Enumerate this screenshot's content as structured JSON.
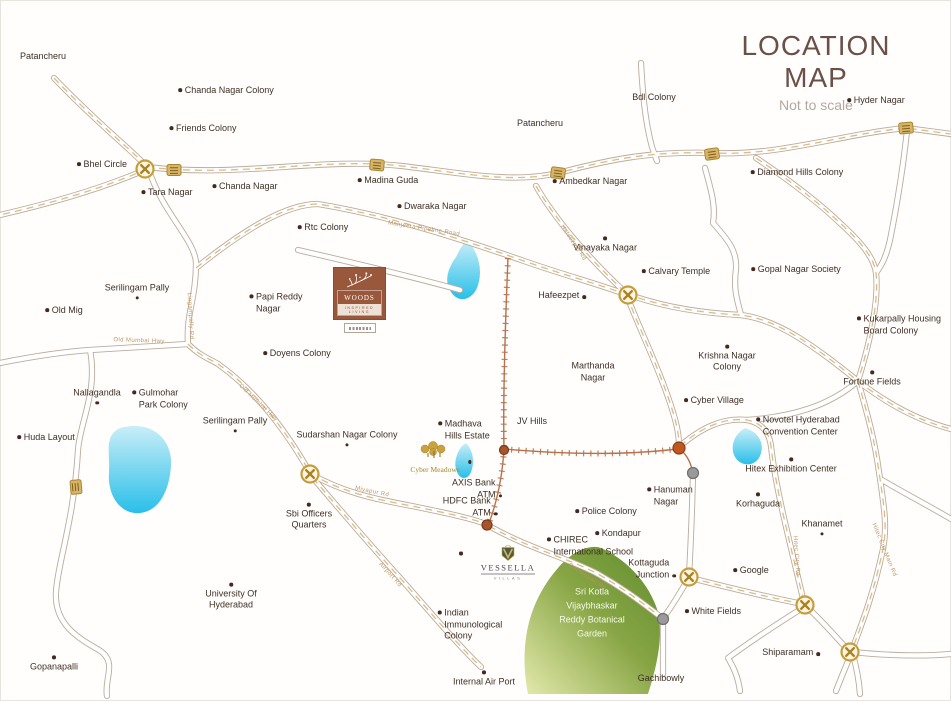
{
  "title": "LOCATION MAP",
  "subtitle": "Not to scale",
  "colors": {
    "title": "#6b5048",
    "accent_gold": "#c69d3c",
    "road_outline": "#bcab9c",
    "highway_dash": "#d9bd85",
    "water": "#29bfe9",
    "garden_green": "#5f8d2f",
    "logo_brown": "#99573b",
    "railway": "#b5724d",
    "label_text": "#3f2f26"
  },
  "logos": {
    "woods": {
      "name": "WOODS",
      "tagline": "INSPIRED LIVING"
    },
    "vessella": {
      "name": "VESSELLA",
      "tagline": "VILLAS"
    },
    "cyber_meadows": {
      "label": "Cyber Meadows"
    }
  },
  "garden": {
    "lines": [
      "Sri Kotla",
      "Vijaybhaskar",
      "Reddy Botanical",
      "Garden"
    ]
  },
  "places": [
    {
      "t": [
        "Patancheru"
      ],
      "x": 43,
      "y": 57,
      "d": "n"
    },
    {
      "t": [
        "Chanda Nagar Colony"
      ],
      "x": 226,
      "y": 91,
      "d": "l"
    },
    {
      "t": [
        "Friends Colony"
      ],
      "x": 203,
      "y": 129,
      "d": "l"
    },
    {
      "t": [
        "Bhel Circle"
      ],
      "x": 102,
      "y": 165,
      "d": "l"
    },
    {
      "t": [
        "Tara Nagar"
      ],
      "x": 167,
      "y": 193,
      "d": "l"
    },
    {
      "t": [
        "Chanda Nagar"
      ],
      "x": 245,
      "y": 187,
      "d": "l"
    },
    {
      "t": [
        "Patancheru"
      ],
      "x": 540,
      "y": 124,
      "d": "n"
    },
    {
      "t": [
        "Madina Guda"
      ],
      "x": 388,
      "y": 181,
      "d": "l"
    },
    {
      "t": [
        "Ambedkar Nagar"
      ],
      "x": 590,
      "y": 182,
      "d": "l"
    },
    {
      "t": [
        "Dwaraka Nagar"
      ],
      "x": 432,
      "y": 207,
      "d": "l"
    },
    {
      "t": [
        "Rtc Colony"
      ],
      "x": 323,
      "y": 228,
      "d": "l"
    },
    {
      "t": [
        "Bdl Colony"
      ],
      "x": 654,
      "y": 98,
      "d": "n"
    },
    {
      "t": [
        "Hyder Nagar"
      ],
      "x": 876,
      "y": 101,
      "d": "l"
    },
    {
      "t": [
        "Diamond Hills Colony"
      ],
      "x": 797,
      "y": 173,
      "d": "l"
    },
    {
      "t": [
        "Vinayaka Nagar"
      ],
      "x": 605,
      "y": 245,
      "d": "a"
    },
    {
      "t": [
        "Calvary Temple"
      ],
      "x": 676,
      "y": 272,
      "d": "l"
    },
    {
      "t": [
        "Gopal Nagar Society"
      ],
      "x": 796,
      "y": 270,
      "d": "l"
    },
    {
      "t": [
        "Kukarpally Housing",
        "Board Colony"
      ],
      "x": 899,
      "y": 325,
      "d": "l"
    },
    {
      "t": [
        "Serilingam Pally"
      ],
      "x": 137,
      "y": 291,
      "d": "b"
    },
    {
      "t": [
        "Old Mig"
      ],
      "x": 64,
      "y": 311,
      "d": "l"
    },
    {
      "t": [
        "Papi Reddy",
        "Nagar"
      ],
      "x": 276,
      "y": 303,
      "d": "l"
    },
    {
      "t": [
        "Doyens Colony"
      ],
      "x": 297,
      "y": 354,
      "d": "l"
    },
    {
      "t": [
        "Krishna Nagar",
        "Colony"
      ],
      "x": 727,
      "y": 359,
      "d": "a"
    },
    {
      "t": [
        "Fortune Fields"
      ],
      "x": 872,
      "y": 379,
      "d": "a"
    },
    {
      "t": [
        "Marthanda",
        "Nagar"
      ],
      "x": 593,
      "y": 372,
      "d": "n"
    },
    {
      "t": [
        "Hafeezpet"
      ],
      "x": 562,
      "y": 296,
      "d": "r"
    },
    {
      "t": [
        "JV Hills"
      ],
      "x": 532,
      "y": 422,
      "d": "n"
    },
    {
      "t": [
        "Madhava",
        "Hills Estate"
      ],
      "x": 464,
      "y": 430,
      "d": "l"
    },
    {
      "t": [
        "Nallagandla"
      ],
      "x": 97,
      "y": 396,
      "d": "b"
    },
    {
      "t": [
        "Gulmohar",
        "Park Colony"
      ],
      "x": 160,
      "y": 399,
      "d": "l"
    },
    {
      "t": [
        "Serilingam Pally"
      ],
      "x": 235,
      "y": 424,
      "d": "b"
    },
    {
      "t": [
        "Huda Layout"
      ],
      "x": 46,
      "y": 438,
      "d": "l"
    },
    {
      "t": [
        "Sudarshan Nagar Colony"
      ],
      "x": 347,
      "y": 438,
      "d": "b"
    },
    {
      "t": [
        "Cyber Village"
      ],
      "x": 714,
      "y": 401,
      "d": "l"
    },
    {
      "t": [
        "Novotel Hyderabad",
        "Convention Center"
      ],
      "x": 798,
      "y": 426,
      "d": "l"
    },
    {
      "t": [
        "Hitex Exhibition Center"
      ],
      "x": 791,
      "y": 466,
      "d": "a"
    },
    {
      "t": [
        "Korhaguda"
      ],
      "x": 758,
      "y": 501,
      "d": "a"
    },
    {
      "t": [
        "Khanamet"
      ],
      "x": 822,
      "y": 527,
      "d": "b"
    },
    {
      "t": [
        "Hanuman",
        "Nagar"
      ],
      "x": 670,
      "y": 496,
      "d": "l"
    },
    {
      "t": [
        "Sbi Officers",
        "Quarters"
      ],
      "x": 309,
      "y": 517,
      "d": "a"
    },
    {
      "t": [
        "AXIS Bank",
        "ATM"
      ],
      "x": 477,
      "y": 489,
      "d": "r"
    },
    {
      "t": [
        "HDFC Bank",
        "ATM"
      ],
      "x": 470,
      "y": 507,
      "d": "r"
    },
    {
      "t": [
        "Police Colony"
      ],
      "x": 606,
      "y": 512,
      "d": "l"
    },
    {
      "t": [
        "Kondapur"
      ],
      "x": 618,
      "y": 534,
      "d": "l"
    },
    {
      "t": [
        "CHIREC",
        "International School"
      ],
      "x": 590,
      "y": 546,
      "d": "l"
    },
    {
      "t": [
        "Kottaguda",
        "Junction"
      ],
      "x": 652,
      "y": 569,
      "d": "r"
    },
    {
      "t": [
        "Google"
      ],
      "x": 751,
      "y": 571,
      "d": "l"
    },
    {
      "t": [
        "White Fields"
      ],
      "x": 713,
      "y": 612,
      "d": "l"
    },
    {
      "t": [
        "University Of",
        "Hyderabad"
      ],
      "x": 231,
      "y": 597,
      "d": "a"
    },
    {
      "t": [
        "Indian",
        "Immunological",
        "Colony"
      ],
      "x": 470,
      "y": 625,
      "d": "l"
    },
    {
      "t": [
        "Gopanapalli"
      ],
      "x": 54,
      "y": 664,
      "d": "a"
    },
    {
      "t": [
        "Internal Air Port"
      ],
      "x": 484,
      "y": 679,
      "d": "a"
    },
    {
      "t": [
        "Gachibowly"
      ],
      "x": 661,
      "y": 679,
      "d": "n"
    },
    {
      "t": [
        "Shiparamam"
      ],
      "x": 791,
      "y": 653,
      "d": "r"
    }
  ],
  "road_labels": [
    {
      "text": "Manjeera Pipeline Road",
      "x": 424,
      "y": 229,
      "r": 9
    },
    {
      "text": "Old Mumbai Hwy",
      "x": 139,
      "y": 341,
      "r": 2
    },
    {
      "text": "Lingampally Rd",
      "x": 190,
      "y": 316,
      "r": 87
    },
    {
      "text": "Old Mumbai Hwy",
      "x": 258,
      "y": 403,
      "r": 44
    },
    {
      "text": "Miyapur Rd",
      "x": 372,
      "y": 492,
      "r": 12
    },
    {
      "text": "Airport Rd",
      "x": 390,
      "y": 575,
      "r": 48
    },
    {
      "text": "Gachibowli Rd",
      "x": 587,
      "y": 577,
      "r": 33
    },
    {
      "text": "Hitec City Rd",
      "x": 796,
      "y": 556,
      "r": 86
    },
    {
      "text": "Hitec City Main Rd",
      "x": 884,
      "y": 550,
      "r": 68
    },
    {
      "text": "Hafeezpet Rd",
      "x": 573,
      "y": 243,
      "r": 56
    }
  ]
}
